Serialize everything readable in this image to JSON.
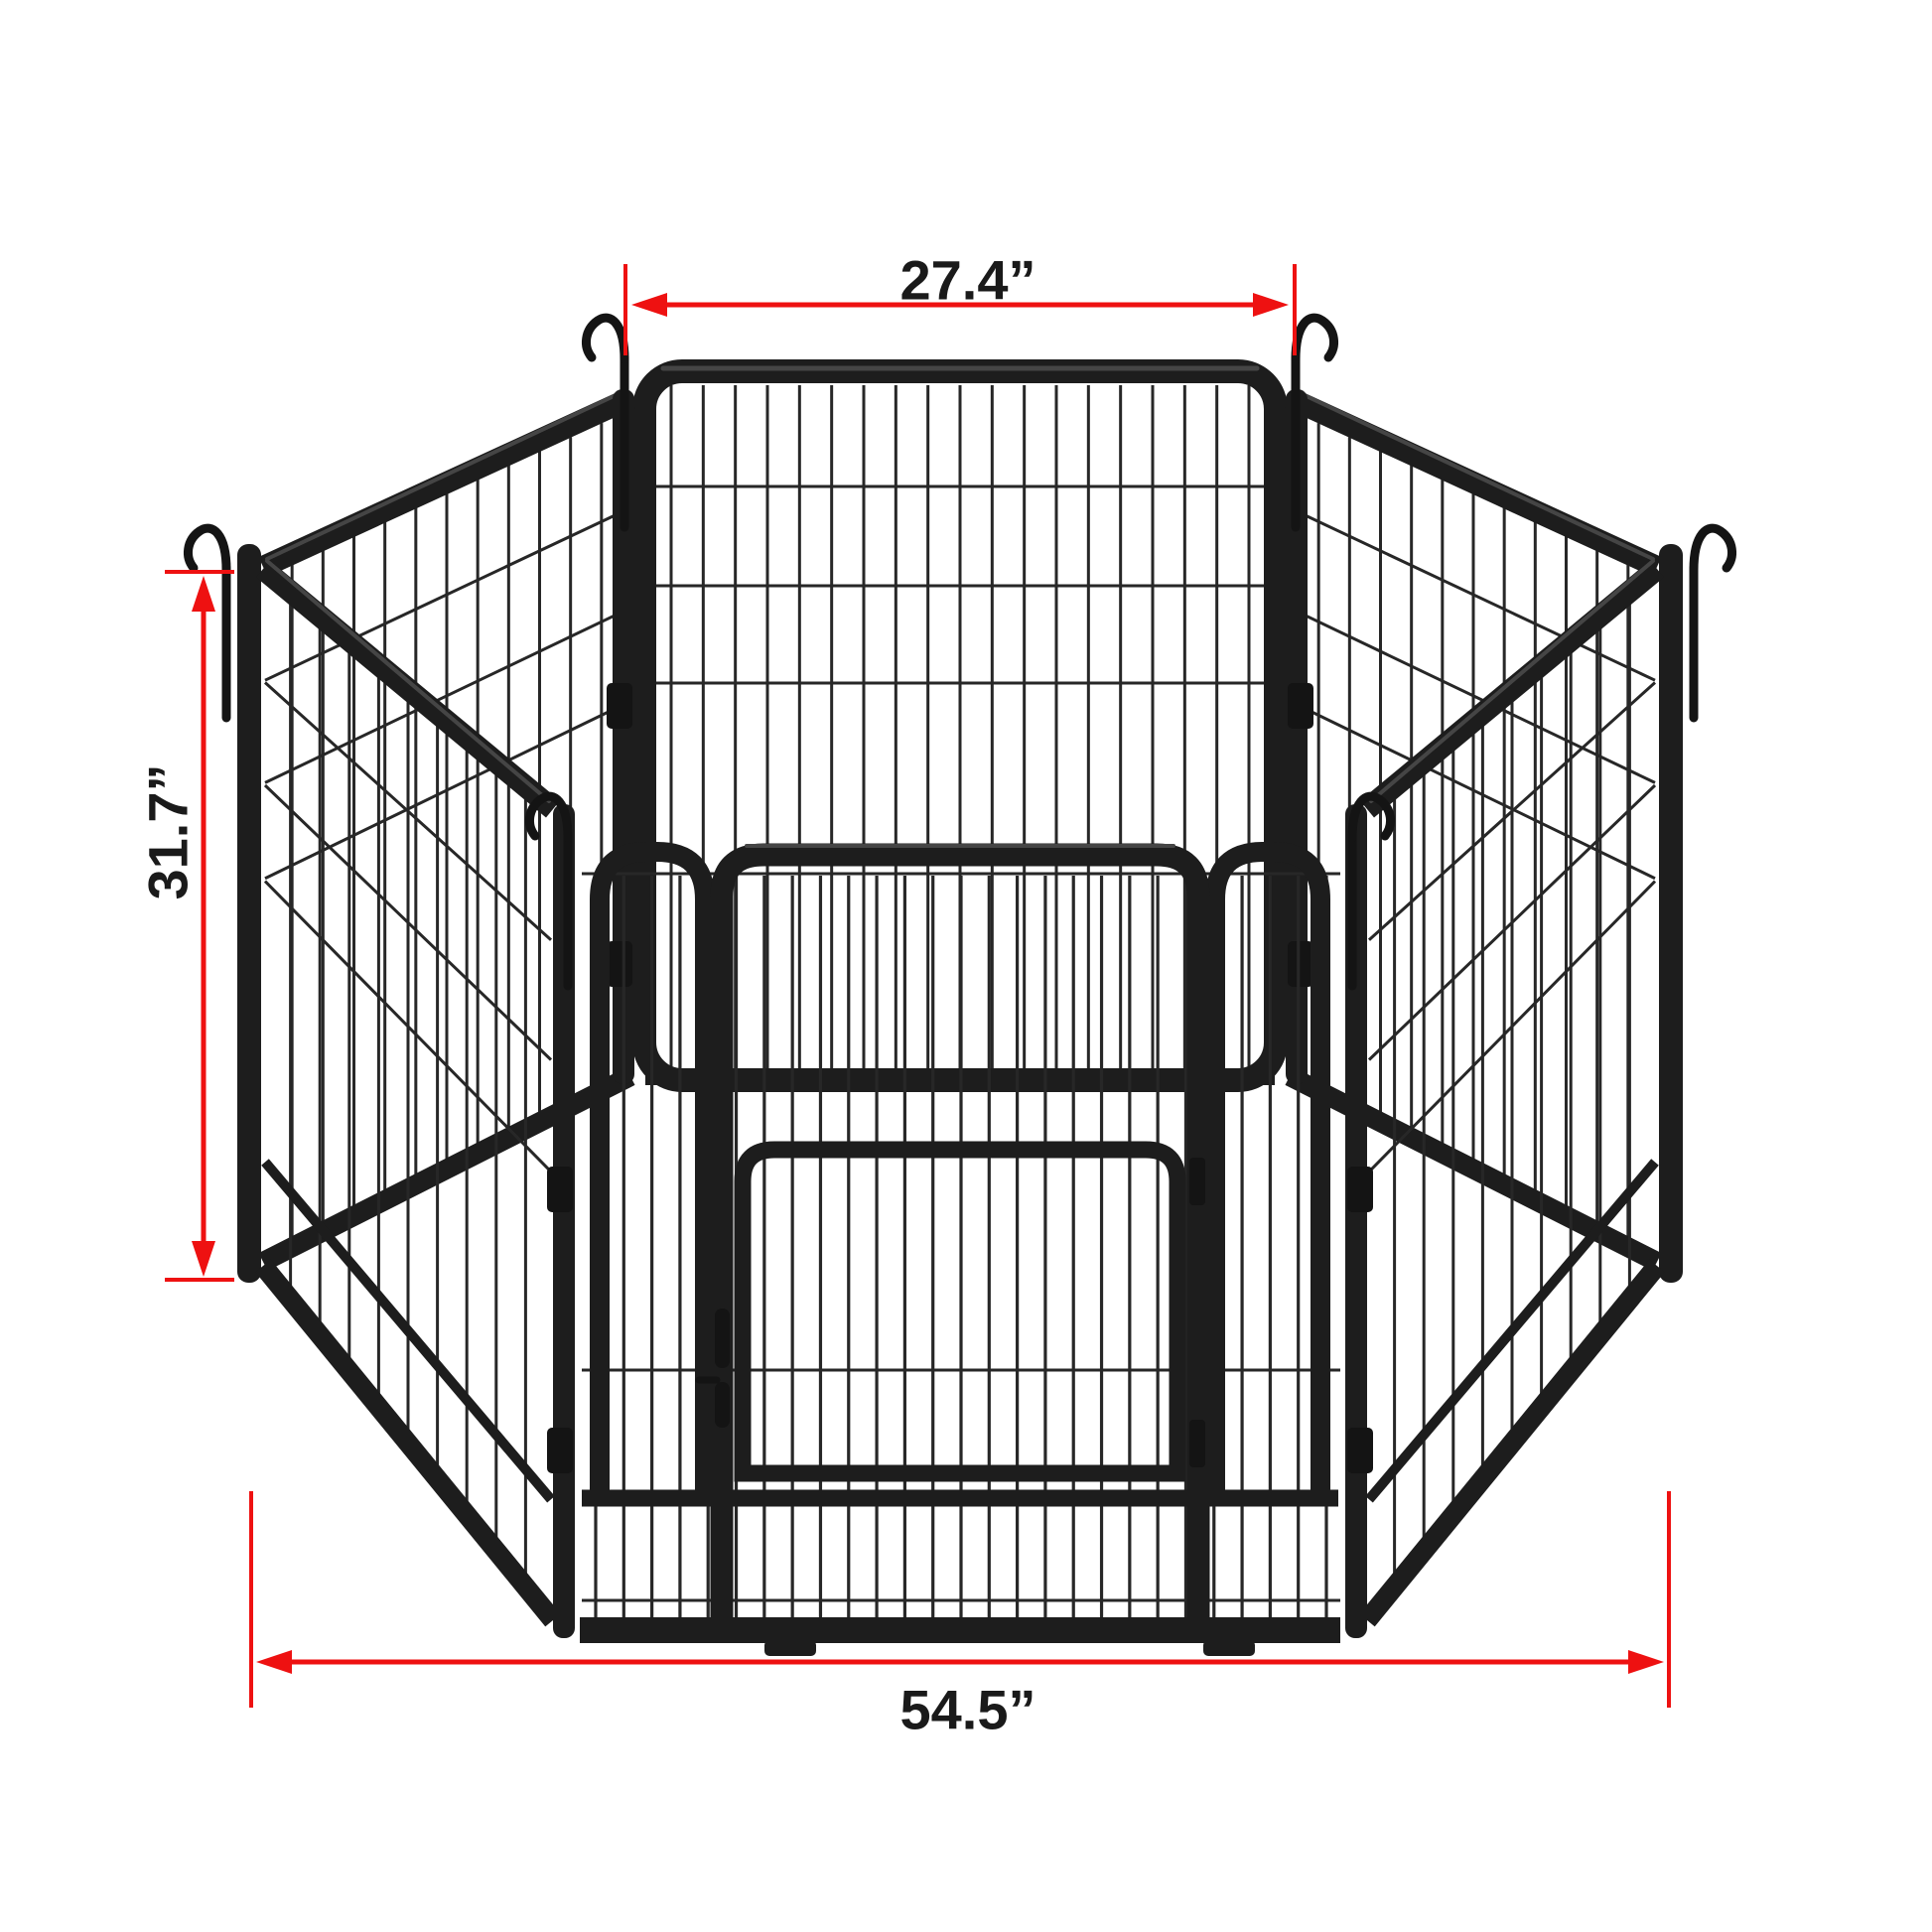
{
  "figure": {
    "description": "Hexagonal 6-panel metal dog playpen with front gate door, shown with dimension annotations",
    "panel_count": 6
  },
  "dimensions": {
    "top_width": {
      "label": "27.4”",
      "value": "27.4",
      "unit": "inches",
      "measures": "single panel width"
    },
    "panel_height": {
      "label": "31.7”",
      "value": "31.7",
      "unit": "inches",
      "measures": "panel height"
    },
    "total_width": {
      "label": "54.5”",
      "value": "54.5",
      "unit": "inches",
      "measures": "overall footprint width"
    }
  },
  "colors": {
    "background": "#ffffff",
    "dimension_line": "#ee1111",
    "label_text": "#1a1a1a",
    "frame": "#1d1d1d",
    "frame_highlight": "#454545",
    "wire": "#272727",
    "hardware": "#141414"
  }
}
